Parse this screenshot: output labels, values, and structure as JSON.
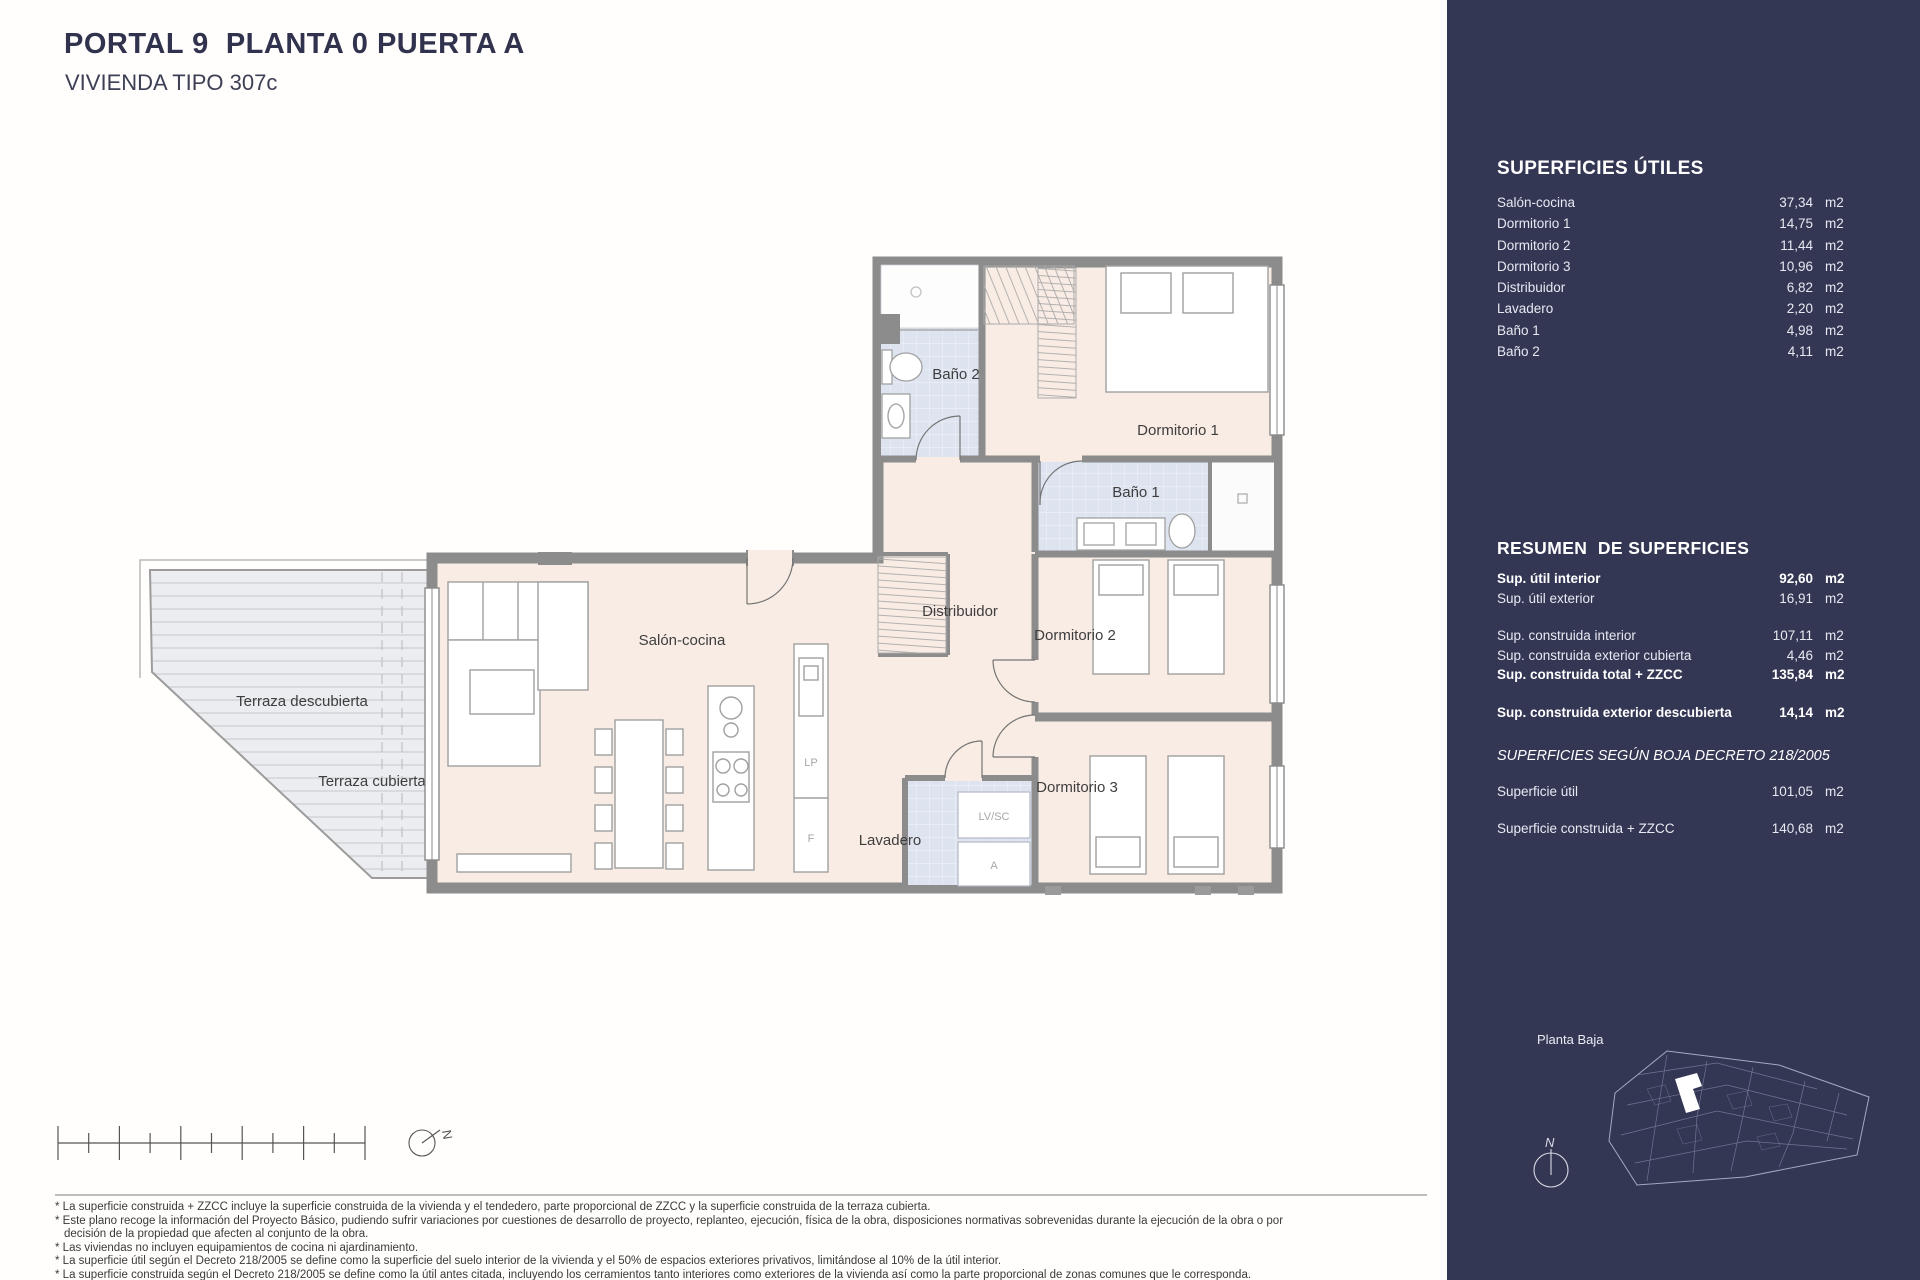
{
  "header": {
    "title": "PORTAL 9  PLANTA 0 PUERTA A",
    "subtitle": "VIVIENDA TIPO 307c"
  },
  "plan": {
    "labels": {
      "terraza_descubierta": "Terraza descubierta",
      "terraza_cubierta": "Terraza cubierta",
      "salon_cocina": "Salón-cocina",
      "distribuidor": "Distribuidor",
      "bano1": "Baño 1",
      "bano2": "Baño 2",
      "dormitorio1": "Dormitorio 1",
      "dormitorio2": "Dormitorio 2",
      "dormitorio3": "Dormitorio 3",
      "lavadero": "Lavadero",
      "lp": "LP",
      "f": "F",
      "lv_sc": "LV/SC",
      "a": "A"
    }
  },
  "scalebar": {
    "north": "N"
  },
  "sidebar": {
    "unit": "m2",
    "utiles": {
      "heading": "SUPERFICIES ÚTILES",
      "items": [
        {
          "label": "Salón-cocina",
          "value": "37,34"
        },
        {
          "label": "Dormitorio 1",
          "value": "14,75"
        },
        {
          "label": "Dormitorio 2",
          "value": "11,44"
        },
        {
          "label": "Dormitorio 3",
          "value": "10,96"
        },
        {
          "label": "Distribuidor",
          "value": "6,82"
        },
        {
          "label": "Lavadero",
          "value": "2,20"
        },
        {
          "label": "Baño 1",
          "value": "4,98"
        },
        {
          "label": "Baño 2",
          "value": "4,11"
        }
      ]
    },
    "resumen": {
      "heading": "RESUMEN  DE SUPERFICIES",
      "rows": [
        {
          "label": "Sup. útil interior",
          "value": "92,60",
          "bold": true
        },
        {
          "label": "Sup. útil exterior",
          "value": "16,91",
          "bold": false
        },
        {
          "label": "Sup. construida interior",
          "value": "107,11",
          "bold": false
        },
        {
          "label": "Sup. construida exterior cubierta",
          "value": "4,46",
          "bold": false
        },
        {
          "label": "Sup. construida total + ZZCC",
          "value": "135,84",
          "bold": true
        },
        {
          "label": "Sup. construida exterior descubierta",
          "value": "14,14",
          "bold": true
        }
      ]
    },
    "boja": {
      "heading": "SUPERFICIES SEGÚN BOJA DECRETO 218/2005",
      "rows": [
        {
          "label": "Superficie útil",
          "value": "101,05"
        },
        {
          "label": "Superficie construida + ZZCC",
          "value": "140,68"
        }
      ]
    },
    "minimap": {
      "label": "Planta Baja",
      "compass": "N"
    }
  },
  "footnotes": [
    "* La superficie construida + ZZCC incluye la superficie construida de la vivienda y el tendedero, parte proporcional de ZZCC y la superficie construida de la terraza cubierta.",
    "* Este plano recoge la información del Proyecto Básico, pudiendo sufrir variaciones por cuestiones de desarrollo de proyecto, replanteo, ejecución, física de la obra, disposiciones normativas sobrevenidas durante la ejecución de la obra o por decisión de la propiedad que afecten al conjunto de la obra.",
    "* Las viviendas no incluyen equipamientos de cocina ni ajardinamiento.",
    "* La superficie útil según el Decreto 218/2005 se define como la superficie del suelo interior de la vivienda y el 50% de espacios exteriores privativos, limitándose al 10% de la útil interior.",
    "* La superficie construida según el Decreto 218/2005 se define como la útil antes citada, incluyendo los cerramientos tanto interiores como exteriores de la vivienda así como la parte proporcional de zonas comunes que le corresponda."
  ],
  "colors": {
    "sidebar_bg": "#343754",
    "title_navy": "#31334e",
    "room_pink": "#f9ece4",
    "bath_blue": "#dde4f0",
    "terrace_gray": "#ecedf0",
    "wall_gray": "#8c8c8c"
  }
}
